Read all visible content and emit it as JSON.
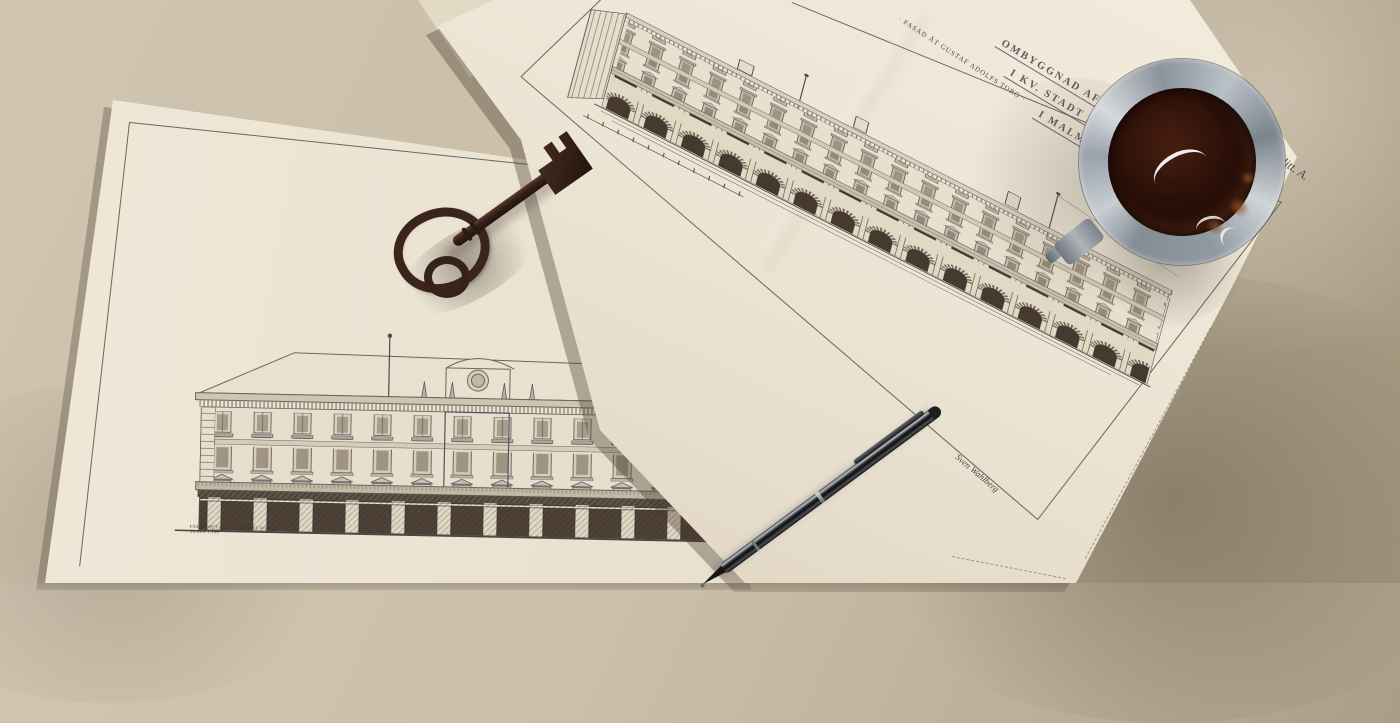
{
  "scene": {
    "description": "Two vintage architectural elevation drawings lying on a desk with an antique skeleton key, a ballpoint pen and a glass of black coffee"
  },
  "sheet_b": {
    "title_lines": [
      "OMBYGGNAD AF BYGGNADEN",
      "I KV. STADT HAMBURG",
      "I MALMÖ."
    ],
    "facade_label": "· FASAD ÅT GUSTAF ADOLFS TORG ·",
    "signature": "Sven Wahlberg",
    "hand_note": "98/92 litt. A.",
    "subject": "Long street elevation with arched ground-floor arcade"
  },
  "sheet_a": {
    "caption_line_1": "FASAD MOT GUSTAF ADOLFS TORG",
    "caption_line_2": "SKALA 1:100",
    "subject": "Front elevation with hipped roof and shop front"
  },
  "objects": {
    "key": "antique skeleton key",
    "pen": "ballpoint pen",
    "coffee": "glass of black coffee"
  },
  "colors": {
    "desk": "#c3b7a0",
    "paper": "#ece4d3",
    "ink": "#4f4c55",
    "key": "#3a241c",
    "pen": "#131416",
    "coffee": "#2b1008",
    "glass": "#aab1b8"
  }
}
